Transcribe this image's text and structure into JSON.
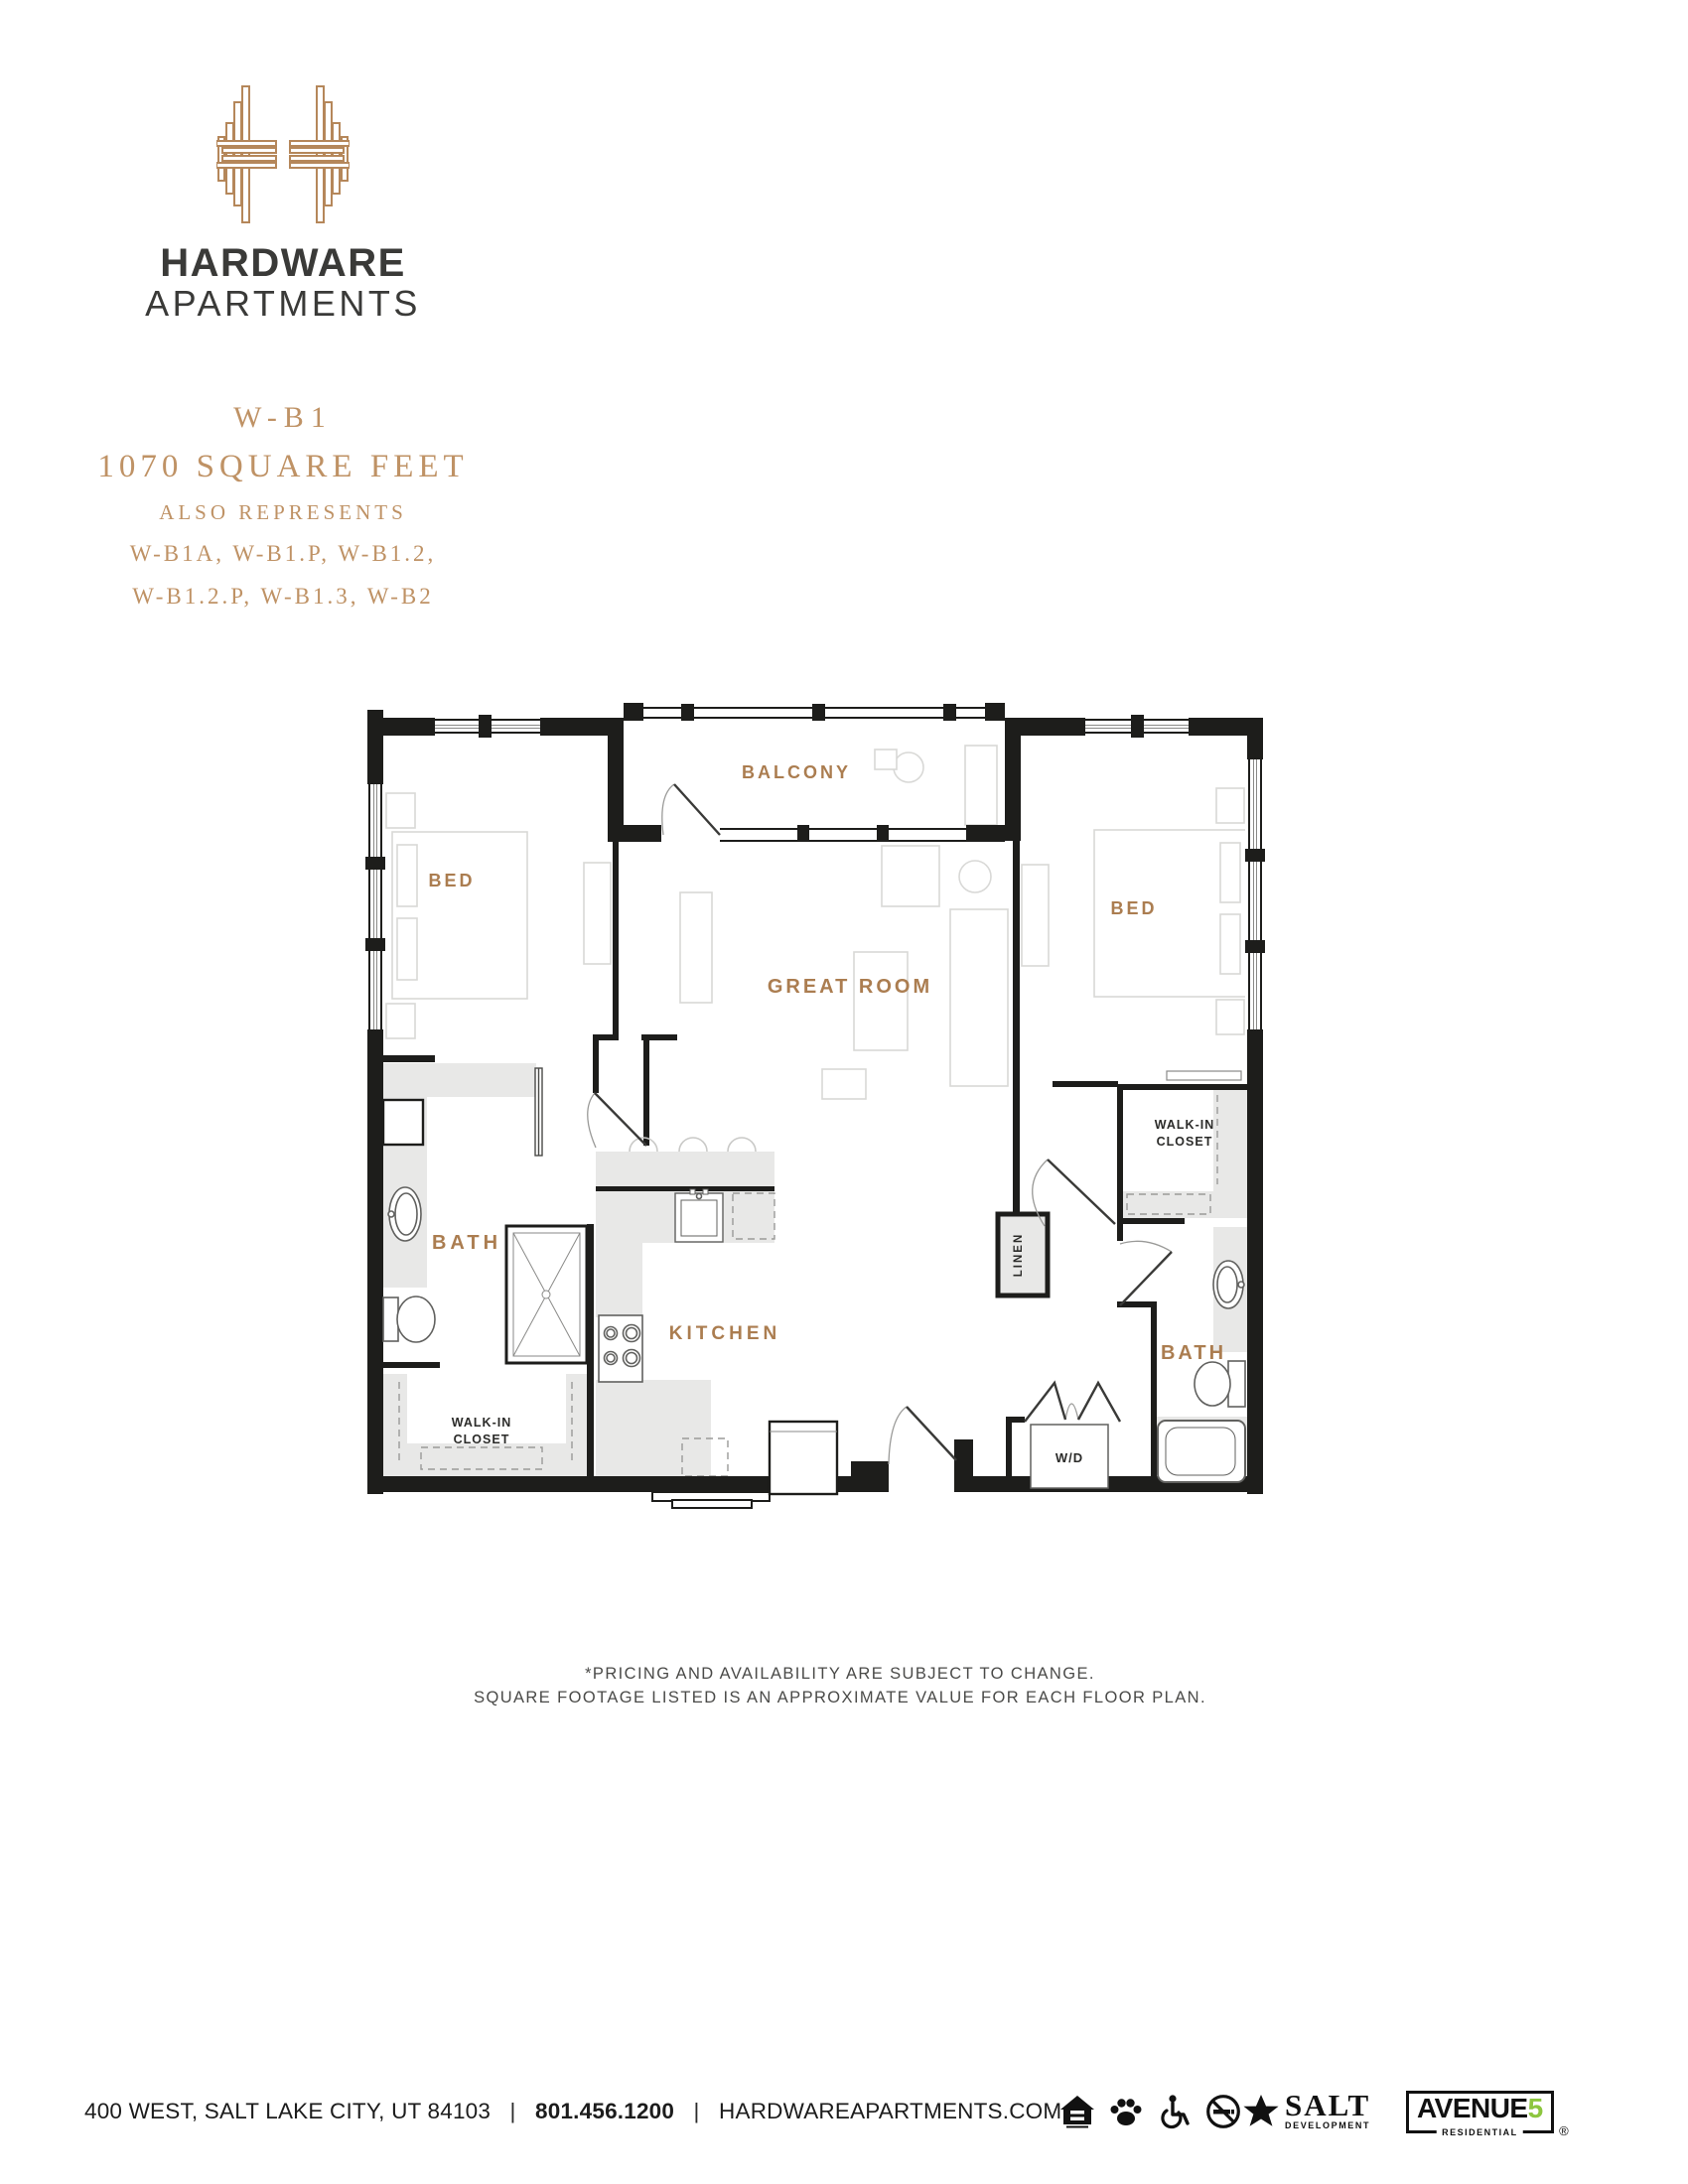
{
  "brand": {
    "name_line1": "HARDWARE",
    "name_line2": "APARTMENTS",
    "logo_color": "#b5875a"
  },
  "plan_header": {
    "plan_code": "W-B1",
    "square_feet": "1070 SQUARE FEET",
    "also_label": "ALSO REPRESENTS",
    "also_line1": "W-B1A, W-B1.P, W-B1.2,",
    "also_line2": "W-B1.2.P, W-B1.3, W-B2",
    "accent_color": "#bf9265"
  },
  "floorplan": {
    "accent_color": "#ab7d50",
    "wall_color": "#1d1d1b",
    "labels": {
      "balcony": "BALCONY",
      "bed_left": "BED",
      "bed_right": "BED",
      "great_room": "GREAT ROOM",
      "bath_left": "BATH",
      "bath_right": "BATH",
      "kitchen": "KITCHEN",
      "walkin_left_line1": "WALK-IN",
      "walkin_left_line2": "CLOSET",
      "walkin_right_line1": "WALK-IN",
      "walkin_right_line2": "CLOSET",
      "linen": "LINEN",
      "washer_dryer": "W/D"
    }
  },
  "disclaimer": {
    "line1": "*PRICING AND AVAILABILITY ARE SUBJECT TO CHANGE.",
    "line2": "SQUARE FOOTAGE LISTED IS AN APPROXIMATE VALUE FOR EACH FLOOR PLAN."
  },
  "footer": {
    "address": "400 WEST, SALT LAKE CITY, UT 84103",
    "separator": "|",
    "phone": "801.456.1200",
    "website": "HARDWAREAPARTMENTS.COM",
    "icons": [
      "equal-housing-icon",
      "pet-friendly-icon",
      "accessible-icon",
      "no-smoking-icon"
    ],
    "salt_logo": {
      "line1": "SALT",
      "line2": "DEVELOPMENT"
    },
    "avenue5_logo": {
      "word": "AVENUE",
      "five": "5",
      "sub": "RESIDENTIAL",
      "reg": "®",
      "five_color": "#8dc63f"
    }
  }
}
